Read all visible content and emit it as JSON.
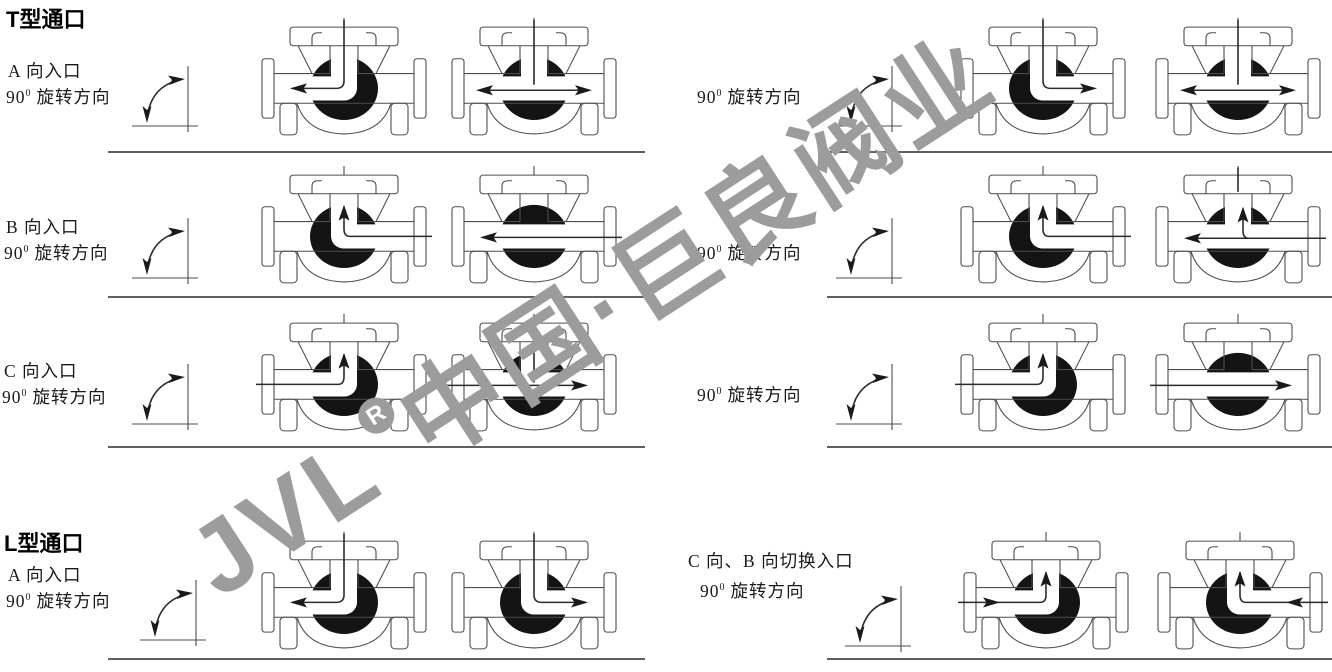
{
  "headings": {
    "t_port": "T型通口",
    "l_port": "L型通口"
  },
  "rotation_label": {
    "deg": "90",
    "deg_sup": "0",
    "text": "旋转方向"
  },
  "left_rows": [
    {
      "entry": "A 向入口",
      "deg": "90",
      "deg_sup": "0",
      "rot": "旋转方向",
      "valves": [
        "top-left",
        "top-both"
      ]
    },
    {
      "entry": "B 向入口",
      "deg": "90",
      "deg_sup": "0",
      "rot": "旋转方向",
      "valves": [
        "right-up",
        "right-left"
      ]
    },
    {
      "entry": "C 向入口",
      "deg": "90",
      "deg_sup": "0",
      "rot": "旋转方向",
      "valves": [
        "left-up",
        "left-right-t"
      ]
    }
  ],
  "right_rows": [
    {
      "deg": "90",
      "deg_sup": "0",
      "rot": "旋转方向",
      "valves": [
        "top-right",
        "top-both"
      ]
    },
    {
      "deg": "90",
      "deg_sup": "0",
      "rot": "旋转方向",
      "valves": [
        "right-up",
        "right-left-up-t"
      ]
    },
    {
      "deg": "90",
      "deg_sup": "0",
      "rot": "旋转方向",
      "valves": [
        "left-up",
        "left-right"
      ]
    }
  ],
  "l_left": {
    "entry": "A 向入口",
    "deg": "90",
    "deg_sup": "0",
    "rot": "旋转方向",
    "valves": [
      "top-left",
      "top-right"
    ]
  },
  "l_right": {
    "entry": "C 向、B 向切换入口",
    "deg": "90",
    "deg_sup": "0",
    "rot": "旋转方向",
    "valves": [
      "left-in-up",
      "right-in-up"
    ]
  },
  "watermark": {
    "brand": "JVL",
    "reg": "R",
    "company": "中国·巨良阀业",
    "color": "#9c9c9c"
  },
  "icons": {
    "rotation": "rotation-90-icon",
    "valve": "three-way-ball-valve-diagram"
  },
  "colors": {
    "outline": "#4d4d4d",
    "ball": "#141414",
    "arrow": "#1a1a1a",
    "divider": "#5f5f5f",
    "watermark": "#9c9c9c"
  }
}
